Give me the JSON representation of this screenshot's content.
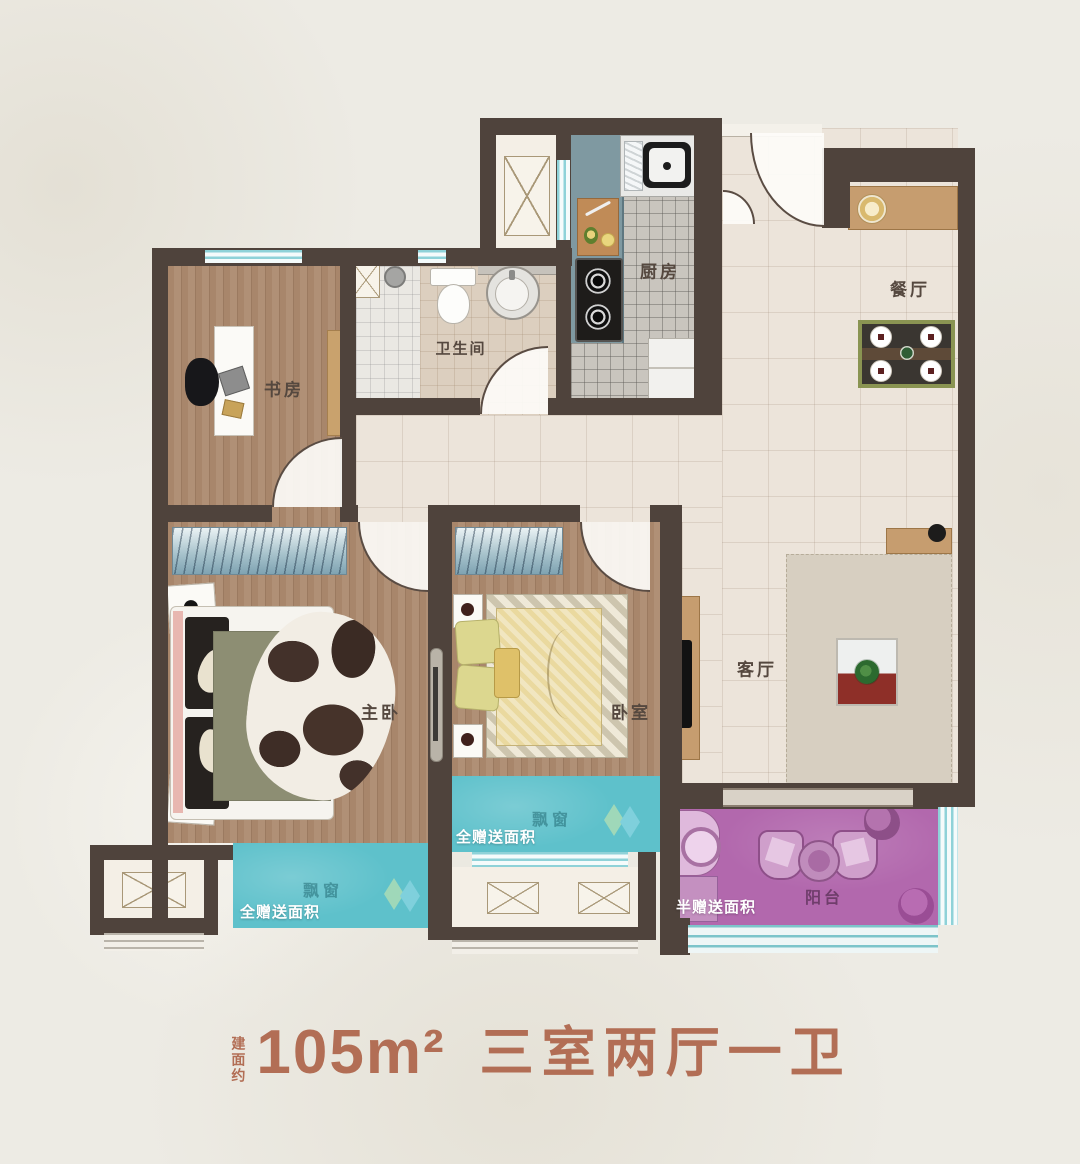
{
  "title": {
    "prefix_vertical": "建面约",
    "area": "105m²",
    "layout_name": "三室两厅一卫"
  },
  "rooms": {
    "study": "书房",
    "bathroom": "卫生间",
    "kitchen": "厨房",
    "dining": "餐厅",
    "master_bedroom": "主卧",
    "bedroom": "卧室",
    "living_room": "客厅",
    "balcony": "阳台"
  },
  "annotations": {
    "bay_window_master": "飘窗",
    "bay_window_second": "飘窗",
    "gift_full_master": "全赠送面积",
    "gift_full_second": "全赠送面积",
    "gift_half_balcony": "半赠送面积"
  },
  "colors": {
    "wall": "#4f433c",
    "bay_window_teal": "#5ec1cb",
    "balcony_purple": "#b268ad",
    "title_terracotta": "#b26e55",
    "wood_floor": "#a8866b",
    "kitchen_counter": "#7f99a1",
    "background": "#edebe4"
  }
}
